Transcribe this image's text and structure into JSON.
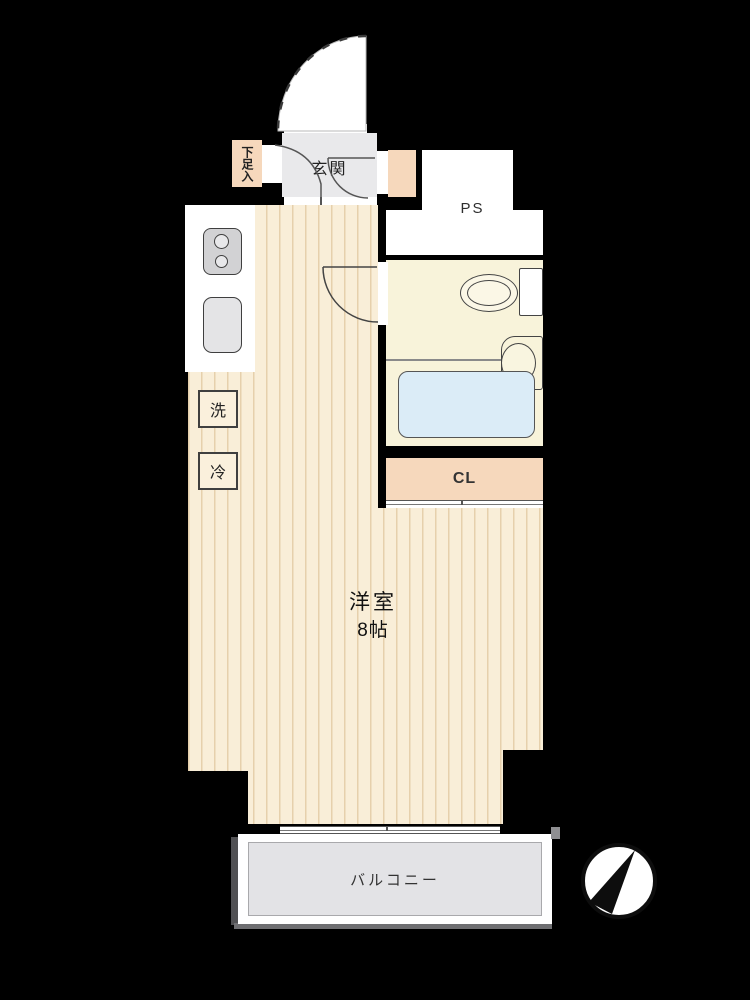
{
  "floorplan": {
    "labels": {
      "entrance": "玄関",
      "shoe_cabinet": "下足入",
      "pipe_space": "PS",
      "closet": "CL",
      "washer": "洗",
      "refrigerator": "冷",
      "room_name": "洋室",
      "room_size": "8帖",
      "balcony": "バルコニー"
    },
    "colors": {
      "background": "#000000",
      "floor_base": "#f9eed8",
      "floor_stripe": "#c69e64",
      "accent_peach": "#f6d8bc",
      "entrance_gray": "#e9e9eb",
      "balcony_gray": "#e3e3e6",
      "wet_area_cream": "#f8f3da",
      "bathtub_blue": "#dbecf7",
      "line_dark": "#3f3f3f",
      "white": "#ffffff"
    }
  }
}
